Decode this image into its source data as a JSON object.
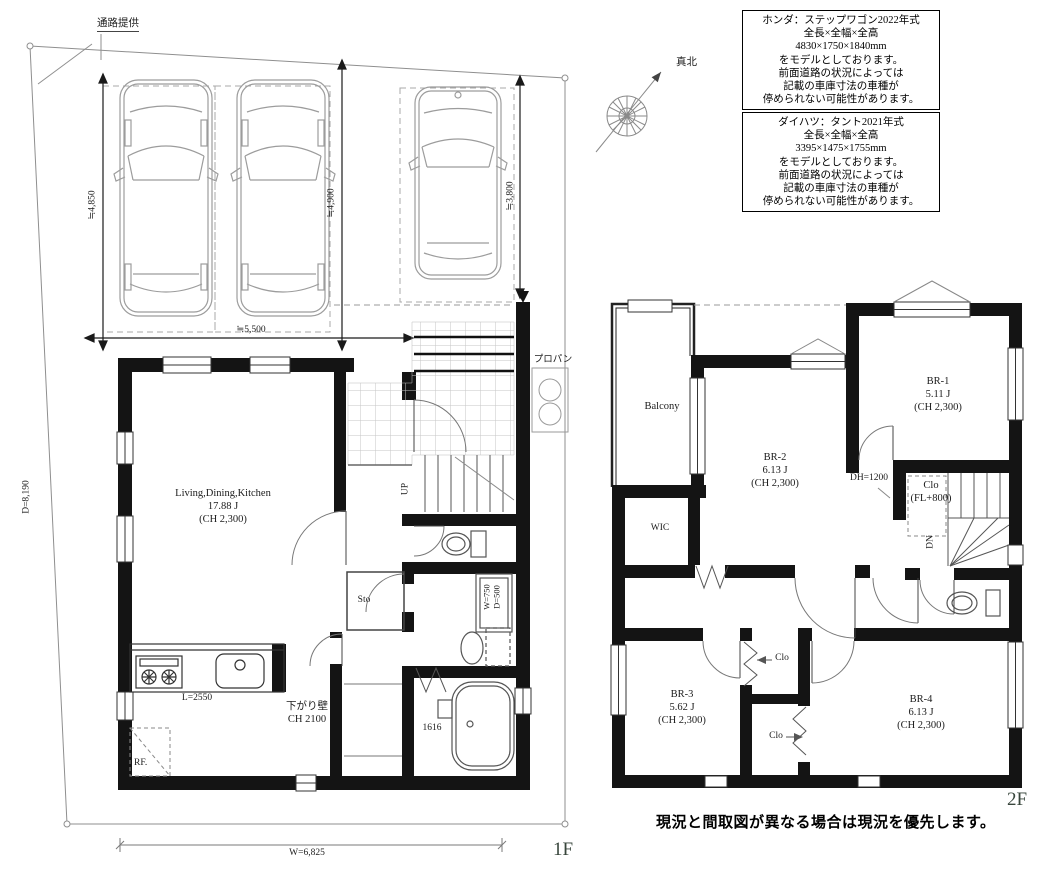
{
  "meta": {
    "floor1_tag": "1F",
    "floor2_tag": "2F",
    "disclaimer": "現況と間取図が異なる場合は現況を優先します。"
  },
  "site": {
    "passage": "通路提供",
    "north": "真北",
    "width_dim": "W=6,825",
    "depth_dim": "D=8,190"
  },
  "parking": {
    "dim_car1": "≒4,850",
    "dim_car2": "≒4,900",
    "dim_car3": "≒3,800",
    "dim_width": "≒5,500"
  },
  "notes": {
    "honda": [
      "ホンダ：ステップワゴン2022年式",
      "全長×全幅×全高",
      "4830×1750×1840mm",
      "をモデルとしております。",
      "前面道路の状況によっては",
      "記載の車庫寸法の車種が",
      "停められない可能性があります。"
    ],
    "daihatsu": [
      "ダイハツ：タント2021年式",
      "全長×全幅×全高",
      "3395×1475×1755mm",
      "をモデルとしております。",
      "前面道路の状況によっては",
      "記載の車庫寸法の車種が",
      "停められない可能性があります。"
    ]
  },
  "f1": {
    "ldk_name": "Living,Dining,Kitchen",
    "ldk_size": "17.88 J",
    "ldk_ch": "(CH 2,300)",
    "counter": "L=2550",
    "fridge": "RF.",
    "sagari1": "下がり壁",
    "sagari2": "CH 2100",
    "sto": "Sto",
    "up": "UP",
    "vanity_w": "W=750",
    "vanity_d": "D=500",
    "bath": "1616",
    "propane": "プロパン"
  },
  "f2": {
    "balcony": "Balcony",
    "br1_name": "BR-1",
    "br1_size": "5.11 J",
    "br1_ch": "(CH 2,300)",
    "br2_name": "BR-2",
    "br2_size": "6.13 J",
    "br2_ch": "(CH 2,300)",
    "br3_name": "BR-3",
    "br3_size": "5.62 J",
    "br3_ch": "(CH 2,300)",
    "br4_name": "BR-4",
    "br4_size": "6.13 J",
    "br4_ch": "(CH 2,300)",
    "wic": "WIC",
    "dn": "DN",
    "dh": "DH=1200",
    "clo_fl1": "Clo",
    "clo_fl2": "(FL+800)",
    "clo_a": "Clo",
    "clo_b": "Clo"
  }
}
